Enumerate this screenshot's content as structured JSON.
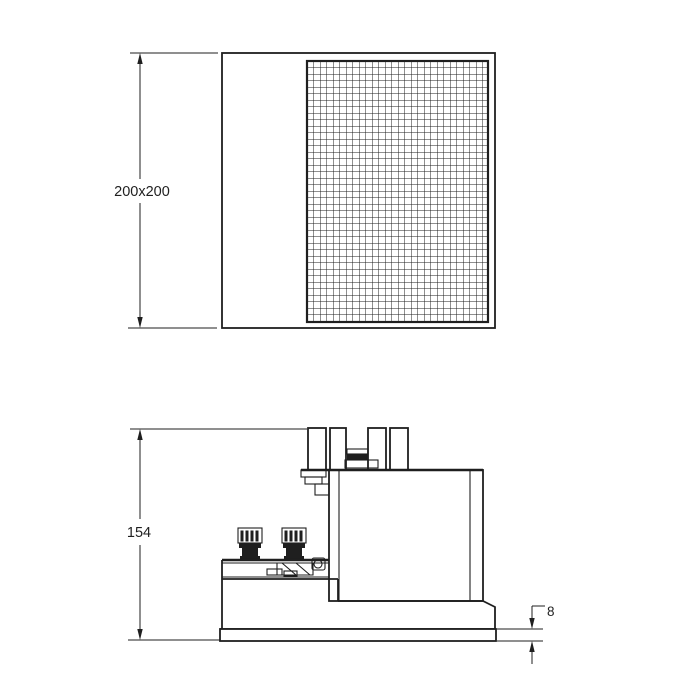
{
  "dimensions": {
    "top_view_size": "200x200",
    "overall_height": "154",
    "trim_thickness": "8"
  },
  "colors": {
    "line": "#1f1f1f",
    "background": "#ffffff",
    "mesh_line": "#1f1f1f"
  }
}
